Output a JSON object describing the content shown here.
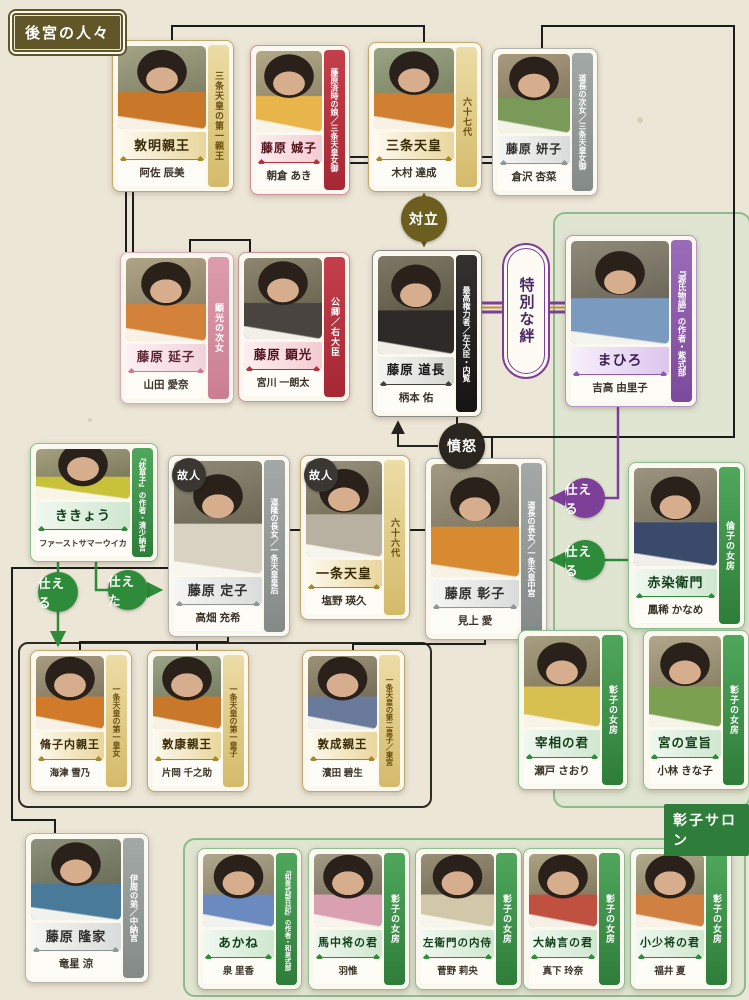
{
  "page_label": "後宮の人々",
  "salon_label": "彰子サロン",
  "relations": {
    "tairitsu": "対立",
    "kizuna": "特別な絆",
    "funnu": "憤怒",
    "tsukaeru": "仕える",
    "tsukaeta": "仕えた",
    "kojin": "故人"
  },
  "colors": {
    "background": "#ece6d7",
    "gold": "#b8962e",
    "red": "#b5323e",
    "pink": "#d4889a",
    "gray": "#8f9696",
    "black": "#1f1f1f",
    "purple": "#7d3f98",
    "green": "#2e8b3a",
    "olive_conflict": "#6b5e1f",
    "panel_border": "#8fba8f"
  },
  "cards": {
    "atsuakira": {
      "name": "敦明親王",
      "actor": "阿佐 辰美",
      "ribbon": "三条天皇の第一親王"
    },
    "seishi": {
      "name": "藤原 娍子",
      "actor": "朝倉 あき",
      "ribbon": "藤原済時の娘／三条天皇女御"
    },
    "sanjo": {
      "name": "三条天皇",
      "actor": "木村 達成",
      "ribbon": "六十七代"
    },
    "kenshi": {
      "name": "藤原 妍子",
      "actor": "倉沢 杏菜",
      "ribbon": "道長の次女／三条天皇女御"
    },
    "enshi": {
      "name": "藤原 延子",
      "actor": "山田 愛奈",
      "ribbon": "顕光の次女"
    },
    "akimitsu": {
      "name": "藤原 顕光",
      "actor": "宮川 一朗太",
      "ribbon": "公卿／右大臣"
    },
    "michinaga": {
      "name": "藤原 道長",
      "actor": "柄本 佑",
      "ribbon": "最高権力者／左大臣・内覧"
    },
    "mahiro": {
      "name": "まひろ",
      "actor": "吉高 由里子",
      "ribbon": "『源氏物語』の作者・紫式部"
    },
    "kikyou": {
      "name": "ききょう",
      "actor": "ファーストサマーウイカ",
      "ribbon": "『枕草子』の作者・清少納言"
    },
    "teishi": {
      "name": "藤原 定子",
      "actor": "高畑 充希",
      "ribbon": "道隆の長女／一条天皇皇后"
    },
    "ichijo": {
      "name": "一条天皇",
      "actor": "塩野 瑛久",
      "ribbon": "六十六代"
    },
    "shoshi": {
      "name": "藤原 彰子",
      "actor": "見上 愛",
      "ribbon": "道長の長女／一条天皇中宮"
    },
    "akazome": {
      "name": "赤染衛門",
      "actor": "鳳稀 かなめ",
      "ribbon": "倫子の女房"
    },
    "shushi": {
      "name": "脩子内親王",
      "actor": "海津 雪乃",
      "ribbon": "一条天皇の第一皇女"
    },
    "atsuyasu": {
      "name": "敦康親王",
      "actor": "片岡 千之助",
      "ribbon": "一条天皇の第一皇子"
    },
    "atsuhira": {
      "name": "敦成親王",
      "actor": "濱田 碧生",
      "ribbon": "一条天皇の第二皇子／東宮"
    },
    "saisho": {
      "name": "宰相の君",
      "actor": "瀬戸 さおり",
      "ribbon": "彰子の女房"
    },
    "miya": {
      "name": "宮の宣旨",
      "actor": "小林 きな子",
      "ribbon": "彰子の女房"
    },
    "takaie": {
      "name": "藤原 隆家",
      "actor": "竜星 涼",
      "ribbon": "伊周の弟／中納言"
    },
    "akane": {
      "name": "あかね",
      "actor": "泉 里香",
      "ribbon": "『和泉式部日記』の作者・和泉式部"
    },
    "uma": {
      "name": "馬中将の君",
      "actor": "羽惟",
      "ribbon": "彰子の女房"
    },
    "saemon": {
      "name": "左衛門の内侍",
      "actor": "菅野 莉央",
      "ribbon": "彰子の女房"
    },
    "dainagon": {
      "name": "大納言の君",
      "actor": "真下 玲奈",
      "ribbon": "彰子の女房"
    },
    "koshosho": {
      "name": "小少将の君",
      "actor": "福井 夏",
      "ribbon": "彰子の女房"
    }
  }
}
